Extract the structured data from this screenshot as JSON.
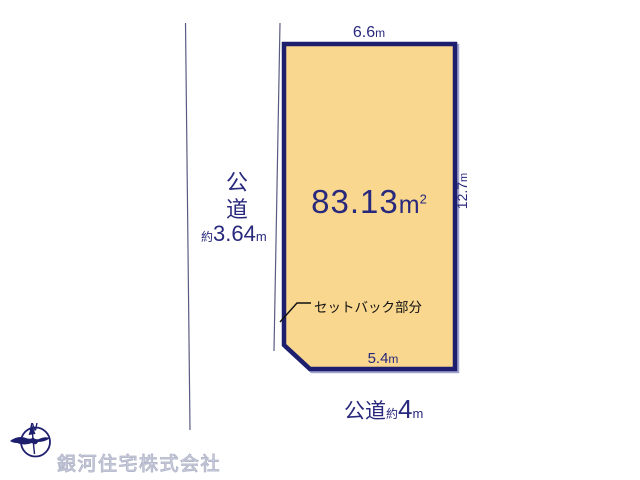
{
  "colors": {
    "plot-fill": "#F9D78E",
    "plot-border": "#1E1E6E",
    "plot-shadow": "#A0A4CC",
    "dim-text": "#28287D",
    "label-text": "#111111",
    "road-line": "#5B5B82",
    "watermark": "#D7DAE6",
    "watermark-edge": "#B4B8CB"
  },
  "plot": {
    "area": {
      "value": "83.13",
      "unit": "m",
      "sup": "2"
    },
    "dims": {
      "top": {
        "value": "6.6",
        "unit": "m"
      },
      "right": {
        "value": "12.7",
        "unit": "m"
      },
      "bottom": {
        "value": "5.4",
        "unit": "m"
      }
    },
    "setback_label": "セットバック部分"
  },
  "roads": {
    "left": {
      "chars": [
        "公",
        "道"
      ],
      "approx": "約",
      "value": "3.64",
      "unit": "m"
    },
    "bottom": {
      "name": "公道",
      "approx": "約",
      "value": "4",
      "unit": "m"
    }
  },
  "footer": {
    "company": "銀河住宅株式会社",
    "compass_n": "N"
  }
}
